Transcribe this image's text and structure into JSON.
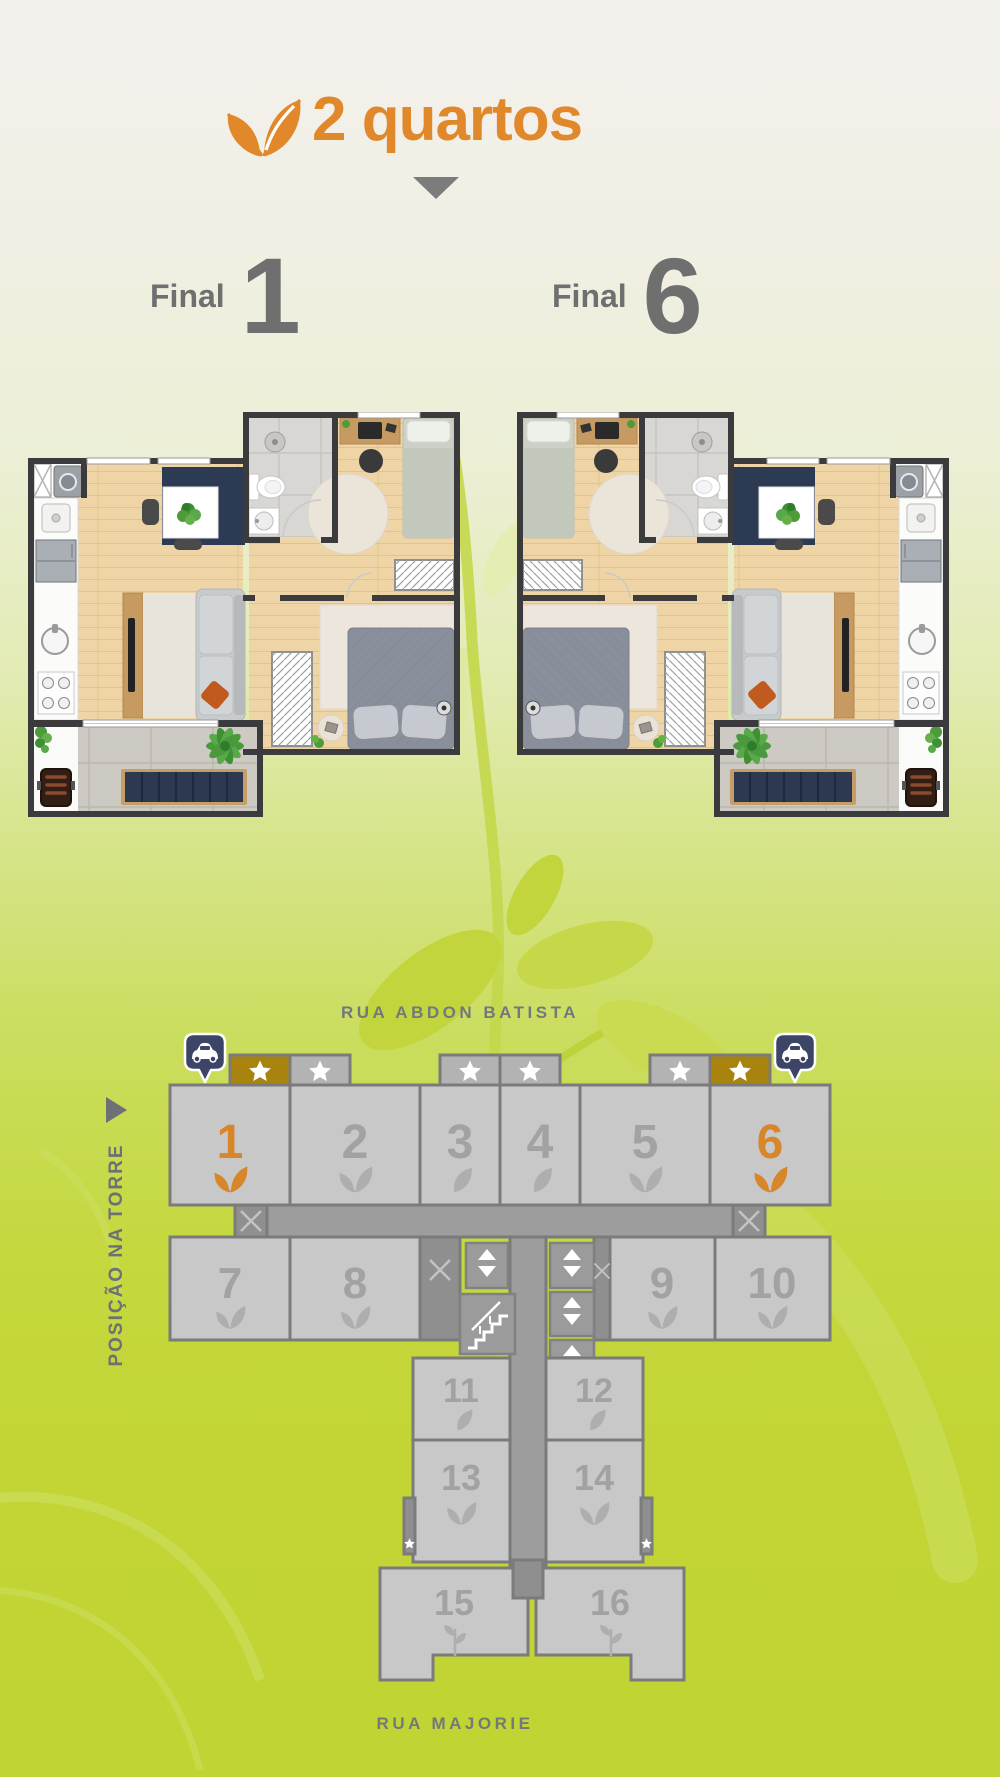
{
  "header": {
    "title": "2 quartos",
    "accent_color": "#e0882a"
  },
  "plans": [
    {
      "label": "Final",
      "number": "1"
    },
    {
      "label": "Final",
      "number": "6"
    }
  ],
  "streets": {
    "top": "RUA ABDON BATISTA",
    "bottom": "RUA MAJORIE"
  },
  "tower": {
    "caption": "POSIÇÃO NA TORRE",
    "highlight_color": "#d8862a",
    "gold_tab_color": "#a8830e",
    "units": [
      {
        "number": "1",
        "highlighted": true,
        "starred": true
      },
      {
        "number": "2",
        "highlighted": false,
        "starred": true
      },
      {
        "number": "3",
        "highlighted": false,
        "starred": true
      },
      {
        "number": "4",
        "highlighted": false,
        "starred": true
      },
      {
        "number": "5",
        "highlighted": false,
        "starred": true
      },
      {
        "number": "6",
        "highlighted": true,
        "starred": true
      },
      {
        "number": "7",
        "highlighted": false,
        "starred": false
      },
      {
        "number": "8",
        "highlighted": false,
        "starred": false
      },
      {
        "number": "9",
        "highlighted": false,
        "starred": false
      },
      {
        "number": "10",
        "highlighted": false,
        "starred": false
      },
      {
        "number": "11",
        "highlighted": false,
        "starred": false
      },
      {
        "number": "12",
        "highlighted": false,
        "starred": false
      },
      {
        "number": "13",
        "highlighted": false,
        "starred": true
      },
      {
        "number": "14",
        "highlighted": false,
        "starred": true
      },
      {
        "number": "15",
        "highlighted": false,
        "starred": false
      },
      {
        "number": "16",
        "highlighted": false,
        "starred": false
      }
    ]
  }
}
